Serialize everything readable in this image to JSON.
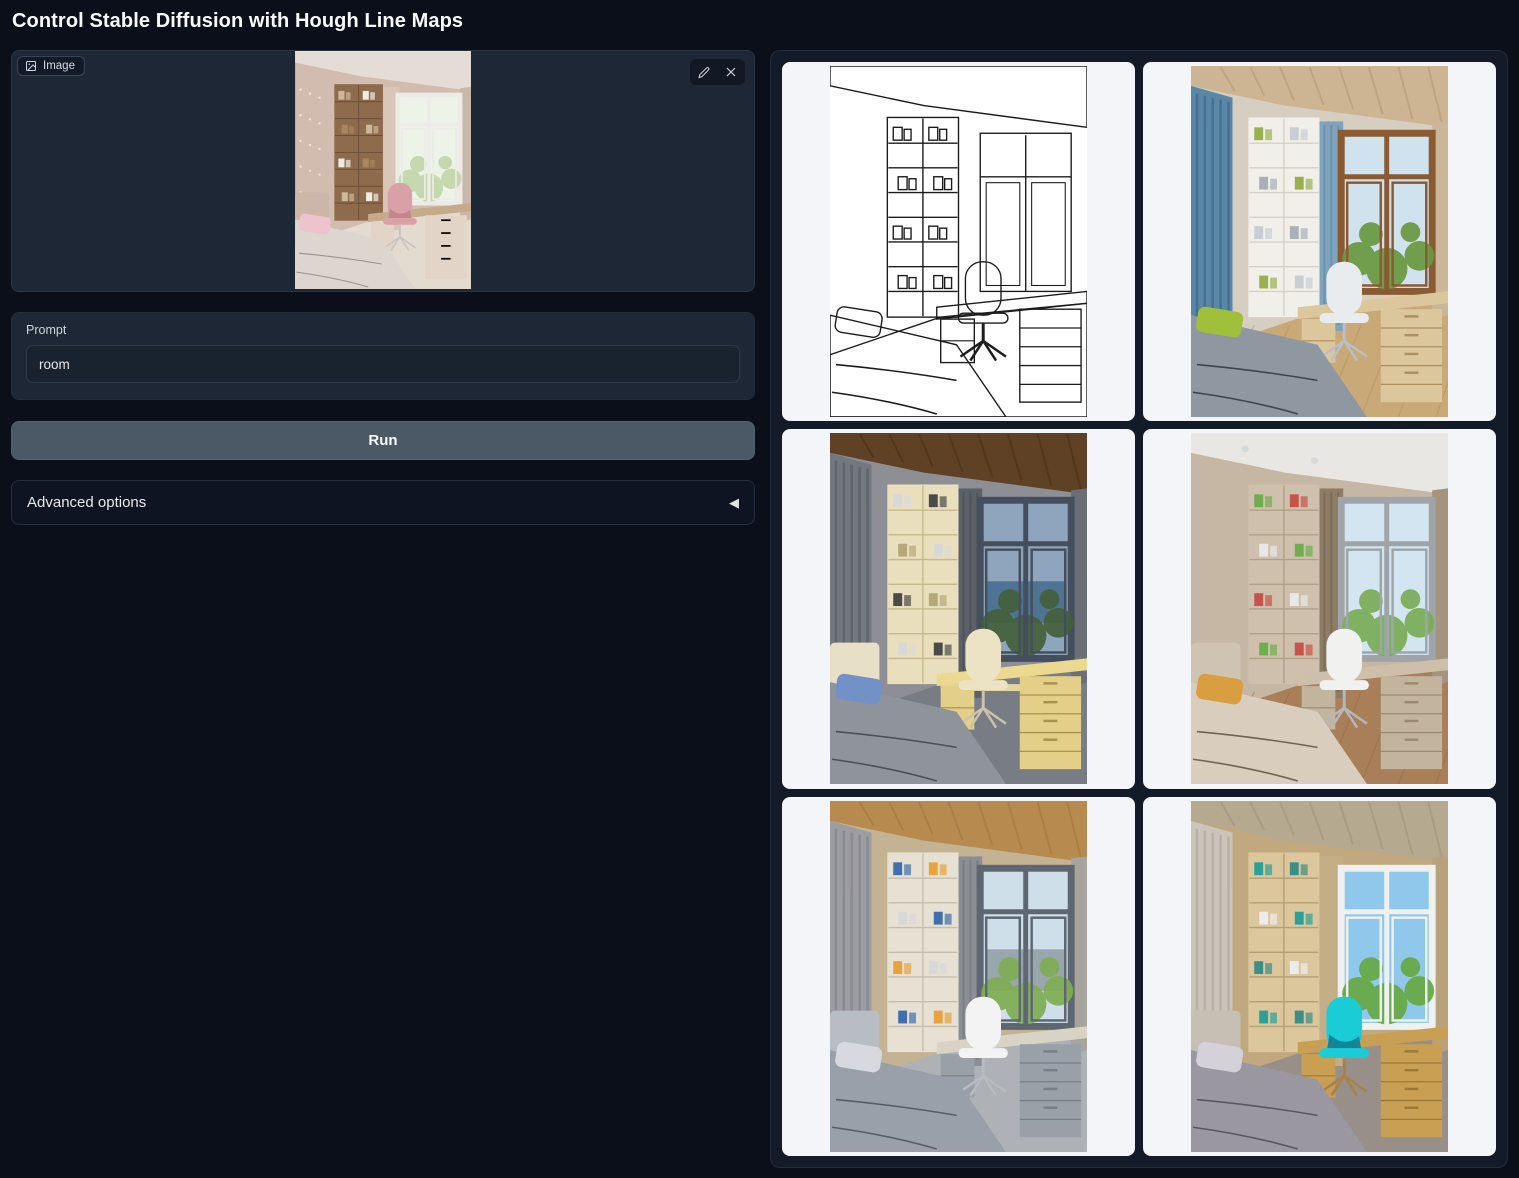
{
  "title": "Control Stable Diffusion with Hough Line Maps",
  "image_panel": {
    "label": "Image"
  },
  "prompt": {
    "label": "Prompt",
    "value": "room"
  },
  "run_button": {
    "label": "Run"
  },
  "advanced_options": {
    "label": "Advanced options",
    "arrow": "◀"
  },
  "colors": {
    "page_bg": "#0b0f19",
    "panel_bg": "#1d2735",
    "input_bg": "#19222f",
    "run_button_bg": "#4b5866",
    "gallery_bg": "#141b28",
    "card_bg": "#f3f5f9",
    "hough_stroke": "#1c1c1c",
    "cyan_chair_accent": "#19ccd6"
  },
  "input_image": {
    "name": "uploaded-room-photo",
    "palette": {
      "wall": "#d2bcb0",
      "ceiling": "#e5ddd5",
      "floor": "#e4dbd0",
      "dots": "#ece2da",
      "shelf": "#8f6b4d",
      "shelfLine": "#6b4e37",
      "books": [
        "#cdb89a",
        "#f0ece4",
        "#a98560"
      ],
      "curtainM": "#d9c6b8",
      "curtainR": "#cbb7a9",
      "windowFrame": "#ecebe7",
      "sky": "#eef3e8",
      "foliage": "#c3d6aa",
      "desk": "#c5ab8c",
      "drawer": "#e2d4c6",
      "drawerLine": "#bba globalization",
      "chair": "#d9a0a8",
      "chairDark": "#c2828c",
      "metal": "#c9c4be",
      "bed": "#dcd6cf",
      "seam": "#9a938c",
      "pillow": "#edc3ce",
      "headboard": "#cbb6a8"
    }
  },
  "gallery": {
    "items": [
      {
        "name": "hough-line-map",
        "palette": {
          "mode": "line",
          "stroke": "#1c1c1c"
        }
      },
      {
        "name": "generated-room-blue-curtains",
        "palette": {
          "wall": "#d7cec2",
          "ceiling": "#cdb493",
          "ceilingSlats": "#b2946f",
          "floor": "#c9a977",
          "floorBoards": "#b18d5c",
          "curtainL": "#5b87a6",
          "curtainLDark": "#3e6a8a",
          "shelf": "#f1efe9",
          "shelfLine": "#d5d1c8",
          "books": [
            "#9ab050",
            "#c9ced4",
            "#aab0b8"
          ],
          "curtainM": "#7fa3bd",
          "curtainMDark": "#5d87a4",
          "curtainR": "#cbb699",
          "windowFrame": "#8a5a33",
          "sky": "#cfe2ee",
          "foliage": "#68993f",
          "desk": "#dcc79c",
          "drawer": "#dcc79c",
          "drawerLine": "#ad9060",
          "chair": "#e9ecef",
          "metal": "#b9bfc6",
          "bed": "#8f97a1",
          "seam": "#3c4450",
          "pillow": "#a0c03c"
        }
      },
      {
        "name": "generated-room-dark-evening",
        "palette": {
          "wall": "#8d8f94",
          "ceiling": "#5f4126",
          "ceilingSlats": "#45300f",
          "floor": "#787d85",
          "curtainL": "#73777e",
          "curtainLDark": "#595d64",
          "shelf": "#eadfbc",
          "shelfLine": "#c6b88c",
          "books": [
            "#d8d8d8",
            "#4a4a4a",
            "#b8a878"
          ],
          "curtainM": "#5c6168",
          "curtainMDark": "#474c54",
          "curtainR": "#6a6f76",
          "windowFrame": "#454e5c",
          "sky": "#8fa5bd",
          "water": "#4f7394",
          "foliage": "#44603a",
          "desk": "#ead98f",
          "drawer": "#e3cf87",
          "drawerLine": "#a8924f",
          "glow": "#f6e4a2",
          "chair": "#ece2c4",
          "metal": "#c9c2ac",
          "bed": "#8e939c",
          "seam": "#4a4f58",
          "pillow": "#7291c7",
          "headboard": "#e7dfc6"
        }
      },
      {
        "name": "generated-room-taupe",
        "palette": {
          "wall": "#c5b7a4",
          "ceiling": "#e9e7e3",
          "spots": true,
          "floor": "#a87f58",
          "floorBoards": "#8f6846",
          "shelf": "#cec0ac",
          "shelfLine": "#b0a088",
          "books": [
            "#6fae4e",
            "#c9524a",
            "#e8e8e8"
          ],
          "curtainM": "#8d7c66",
          "curtainMDark": "#74644f",
          "curtainR": "#a4937e",
          "windowFrame": "#9fa4a9",
          "sky": "#d3e5f0",
          "foliage": "#79ad57",
          "desk": "#cdbfa9",
          "drawer": "#c3b49e",
          "drawerLine": "#9b8a70",
          "chair": "#f1f1ef",
          "metal": "#b4b8bc",
          "bed": "#d9cdbd",
          "seam": "#6b6258",
          "pillow": "#d99e3f",
          "headboard": "#cfc3b1"
        }
      },
      {
        "name": "generated-room-gray-wood",
        "palette": {
          "wall": "#c3b392",
          "ceiling": "#b78a50",
          "ceilingSlats": "#9c7340",
          "floor": "#aeb2b6",
          "curtainL": "#9c9ca2",
          "curtainLDark": "#83838b",
          "shelf": "#e7e1d3",
          "shelfLine": "#c5bead",
          "books": [
            "#3f6fae",
            "#e8a33f",
            "#d8d8d8"
          ],
          "curtainM": "#8b8e94",
          "curtainMDark": "#717479",
          "curtainR": "#a8a49c",
          "windowFrame": "#5d6671",
          "sky": "#cfdfe9",
          "water": "#99a6ad",
          "foliage": "#7fae53",
          "desk": "#d9d3c6",
          "drawer": "#9aa0a8",
          "drawerLine": "#787e87",
          "chair": "#f3f3f3",
          "metal": "#b8bcc0",
          "bed": "#9aa0aa",
          "seam": "#565d68",
          "pillow": "#d7d9de",
          "headboard": "#b8bdc4"
        }
      },
      {
        "name": "generated-room-cyan-chair",
        "palette": {
          "wall": "#c2a87e",
          "ceiling": "#b5a98f",
          "ceilingSlats": "#9c9078",
          "floor": "#989088",
          "curtainL": "#cbc4ba",
          "curtainLDark": "#b2aa9e",
          "shelf": "#dcc69c",
          "shelfLine": "#b59e74",
          "books": [
            "#2aa198",
            "#3a8f88",
            "#ececec"
          ],
          "curtainM": "#c4ae88",
          "curtainR": "#b8a27c",
          "windowFrame": "#eff0f0",
          "sky": "#90c8ec",
          "foliage": "#67a944",
          "desk": "#c99f54",
          "drawer": "#c99f54",
          "drawerLine": "#9d7937",
          "chair": "#19ccd6",
          "chairDark": "#0d7e95",
          "metal": "#a8824c",
          "bed": "#9b97a1",
          "seam": "#5a565e",
          "pillow": "#d4d2d8",
          "headboard": "#c6bfb4"
        }
      }
    ]
  }
}
